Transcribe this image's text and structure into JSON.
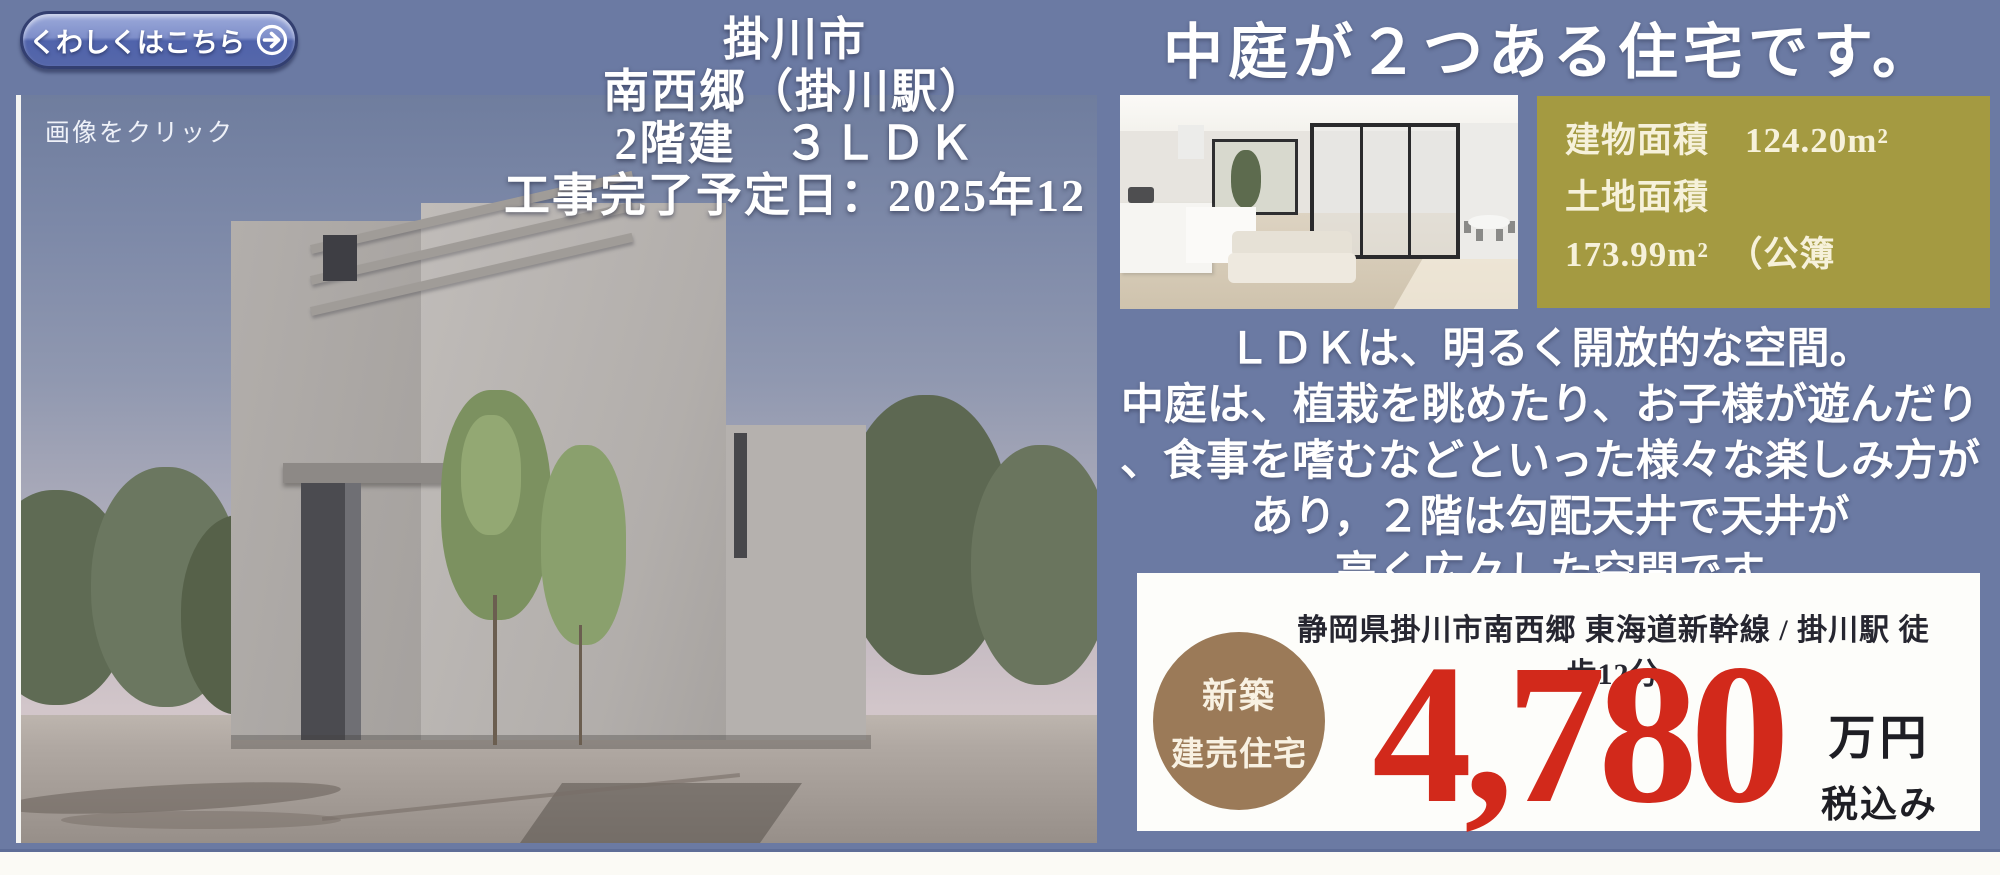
{
  "cta_button": {
    "label": "くわしくはこちら"
  },
  "photo": {
    "caption": "画像をクリック"
  },
  "property_title": {
    "line1": "掛川市",
    "line2": "南西郷（掛川駅）",
    "line3": "2階建　３ＬＤＫ",
    "line4": "工事完了予定日：2025年12"
  },
  "headline": "中庭が２つある住宅です。",
  "area_box": {
    "line1": "建物面積　124.20m²",
    "line2": "土地面積",
    "line3": "173.99m²　（公簿"
  },
  "description": {
    "line1": "ＬＤＫは、明るく開放的な空間。",
    "line2": "中庭は、植栽を眺めたり、お子様が遊んだり",
    "line3": "、食事を嗜むなどといった様々な楽しみ方が",
    "line4": "あり，２階は勾配天井で天井が",
    "line5": "高く広々した空間です"
  },
  "price_box": {
    "address": "静岡県掛川市南西郷 東海道新幹線 / 掛川駅 徒歩12分",
    "badge_line1": "新築",
    "badge_line2": "建売住宅",
    "price": "4,780",
    "unit": "万円",
    "tax_note": "税込み"
  },
  "colors": {
    "background": "#6b7aa3",
    "area_box_bg": "#a49a41",
    "badge_bg": "#9b7a58",
    "price_red": "#d2291b",
    "bottom_strip": "#fbfaf5"
  }
}
